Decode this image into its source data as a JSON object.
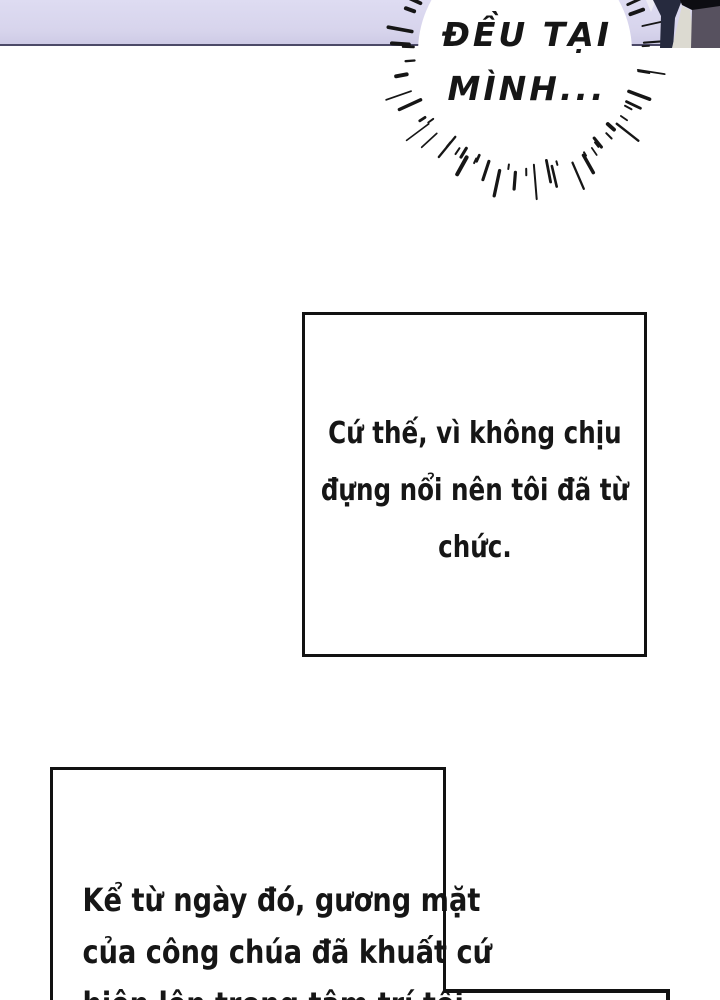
{
  "comic": {
    "speech_bubble": {
      "line1": "ĐỀU TẠI",
      "line2": "MÌNH..."
    },
    "caption_mid": {
      "line1": "Cứ thế, vì không chịu",
      "line2": "đựng nổi nên tôi đã từ",
      "line3": "chức."
    },
    "caption_bottom": {
      "line1": "Kể từ ngày đó, gương mặt",
      "line2": "của công chúa đã khuất cứ",
      "line3": "hiện lên trong tâm trí tôi"
    },
    "colors": {
      "band": "#d7d4ec",
      "band_line": "#4c4a68",
      "ink": "#161616",
      "figure_navy": "#262a3e",
      "figure_cream": "#dcdad1",
      "figure_gray": "#57515f",
      "figure_black": "#0d0d12",
      "figure_light": "#eeedf5"
    }
  }
}
